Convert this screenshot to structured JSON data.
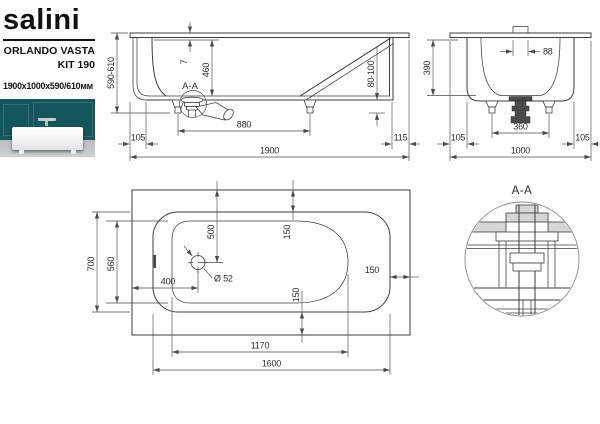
{
  "colors": {
    "line": "#3d3d3d",
    "dim": "#4a4a4a",
    "text": "#2e2e2e",
    "fill_gray": "#d6d6d6",
    "photo_wall": "#14565c",
    "photo_floor": "#b9bdbd",
    "brand_ink": "#111111"
  },
  "brand": {
    "logo": "salini",
    "product": "ORLANDO VASTA",
    "kit": "KIT 190",
    "size": "1900x1000x590/610мм"
  },
  "side_view": {
    "section_label": "A-A",
    "dims": {
      "height": "590-610",
      "rim_thickness": "7",
      "inner_depth": "460",
      "bottom_clearance": "80-100",
      "left_offset": "105",
      "foot_spacing": "880",
      "total_length": "1900",
      "right_offset": "115"
    }
  },
  "end_view": {
    "dims": {
      "overflow_width": "88",
      "inner_depth": "390",
      "foot_spacing": "360",
      "left_offset": "105",
      "total_width": "1000",
      "right_offset": "105"
    }
  },
  "top_view": {
    "dims": {
      "rim_width": "700",
      "bowl_width": "560",
      "drain_offset_top": "500",
      "drain_offset_left": "400",
      "drain_diameter": "Ø 52",
      "edge_gap_top": "150",
      "edge_gap_right": "150",
      "edge_gap_bottom": "150",
      "bowl_length": "1170",
      "rim_length": "1600"
    }
  },
  "detail_view": {
    "title": "A-A"
  }
}
